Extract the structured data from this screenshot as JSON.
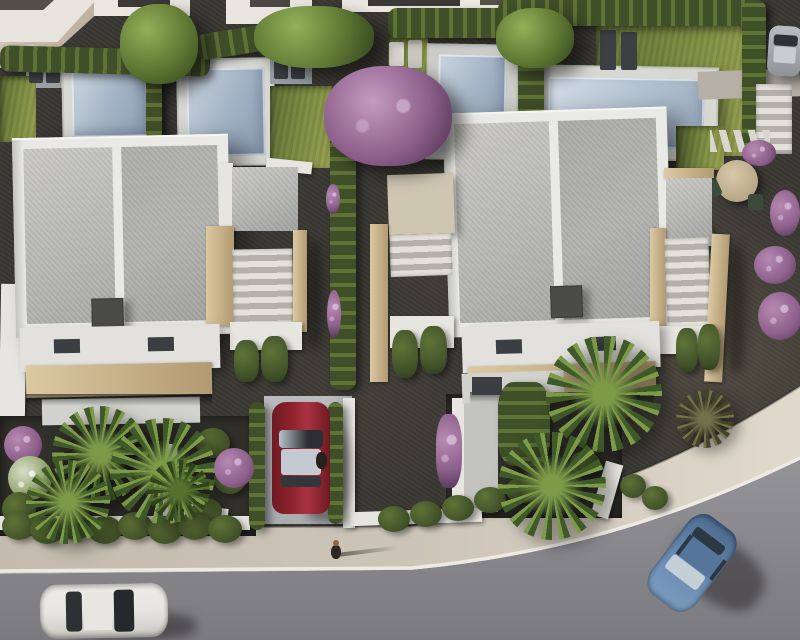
{
  "scene": {
    "type": "aerial-3d-architectural-render",
    "description": "Top-down bird's-eye render of a modern white villa development: two flat-roof villas in the foreground, four swimming pools with surrounding gardens behind them, hedge-lined plots, palm trees, purple flowering shrubs, a red car parked in a driveway, a curving street at the bottom with a white car and a blue car, and two pedestrians.",
    "objects": {
      "villas": 2,
      "swimming_pools": 4,
      "cars": [
        "red car parked in driveway",
        "white car on road bottom left",
        "blue car on road bottom right",
        "gray car at top right edge"
      ],
      "pedestrians": [
        "person walking on sidewalk",
        "person standing beside red car"
      ],
      "vegetation": [
        "boxwood hedges",
        "palm trees",
        "purple flowering tree",
        "purple bougainvillea shrubs",
        "green trees",
        "lawns"
      ],
      "hardscape": [
        "gravel yards",
        "white garden walls",
        "travertine stair walls",
        "stepping stones",
        "exterior stairs",
        "sidewalk",
        "asphalt road"
      ],
      "furniture": [
        "sun loungers",
        "round garden table with chairs"
      ]
    }
  },
  "palette": {
    "gravel": "#3a3833",
    "grass": "#5d6e33",
    "grass-light": "#97a24f",
    "hedge-dark": "#3f4f28",
    "hedge-light": "#5f7337",
    "tree": "#5e7733",
    "palm-dark": "#3f5a28",
    "palm-light": "#7d9a48",
    "purple": "#8d5f8b",
    "purple-light": "#b58ab2",
    "pool-water": "#a4b4c6",
    "pool-deck": "#d7d8d3",
    "roof": "#b4b5b2",
    "parapet": "#e9e9e6",
    "stone": "#dcc9a2",
    "stone-dark": "#b29a72",
    "white-wall": "#e7e5e0",
    "sidewalk": "#c9c1b4",
    "sidewalk-light": "#ded7ca",
    "curb": "#edeae3",
    "road": "#8e8d92",
    "road-dark": "#7d7c81",
    "car-red": "#94252f",
    "car-white": "#e7e5e0",
    "car-blue": "#6486ab",
    "car-gray": "#a6a9ad"
  }
}
